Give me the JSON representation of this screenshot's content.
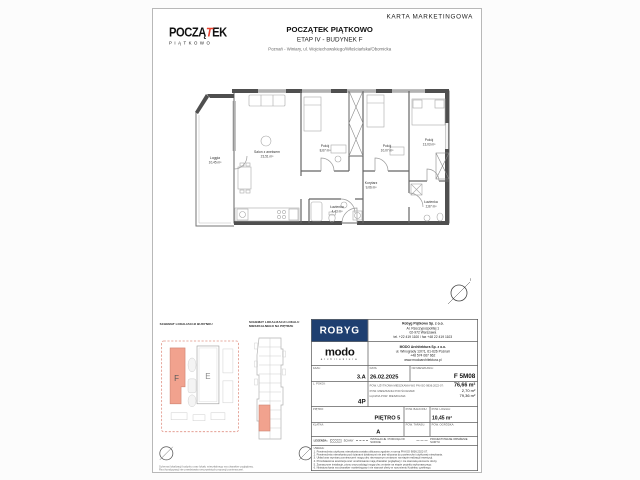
{
  "header": {
    "karta_label": "KARTA MARKETINGOWA",
    "logo": {
      "part1": "POCZĄ",
      "part2": "T",
      "part3": "EK",
      "sub": "PIĄTKOWO"
    },
    "title": "POCZĄTEK PIĄTKOWO",
    "subtitle": "ETAP IV - BUDYNEK F",
    "address": "Poznań - Winiary, ul. Wojciechowskiego/Włościańska/Obornicka"
  },
  "plan": {
    "rooms": [
      {
        "name": "Loggia",
        "area": "10,45 m²"
      },
      {
        "name": "Salon z aneksem",
        "area": "23,51 m²"
      },
      {
        "name": "Pokój",
        "area": "8,67 m²"
      },
      {
        "name": "Pokój",
        "area": "10,07 m²"
      },
      {
        "name": "Pokój",
        "area": "13,03 m²"
      },
      {
        "name": "Korytarz",
        "area": "9,06 m²"
      },
      {
        "name": "Łazienka",
        "area": "4,43 m²"
      },
      {
        "name": "Łazienka",
        "area": "2,87 m²"
      }
    ],
    "compass_letter": "N"
  },
  "schematics": {
    "building_title": "SCHEMAT LOKALIZACJI BUDYNKU",
    "floor_title_line1": "SCHEMAT LOKALIZACJI LOKALU",
    "floor_title_line2": "MIESZKALNEGO NA PIĘTRZE",
    "building_f": "F",
    "building_e": "E",
    "note_line1": "Schemat lokalizacji budynku oraz lokalu mieszkalnego ma charakter poglądowy.",
    "note_line2": "Rzut kondygnacji nie przedstawia rzeczywistych proporcji pomieszczeń."
  },
  "developer": {
    "logo": "ROBYG",
    "name": "Robyg Piątkowo Sp. z o.o.",
    "address1": "Al. Rzeczypospolitej 1",
    "address2": "02-972 Warszawa",
    "phone": "tel. +22 419 1100 / fax +48 22 419 1103"
  },
  "architect": {
    "logo": "modo",
    "logo_sub": "architektura",
    "name": "MODO Architektura Sp. z o.o.",
    "address1": "ul. Winogrady 137/1, 61-626 Poznań",
    "phone": "+48 574 067 662",
    "www": "www.modoarchitektura.pl"
  },
  "table": {
    "faza_label": "FAZA:",
    "faza": "3.A",
    "data_label": "DATA:",
    "data": "26.02.2025",
    "nr_label": "NR MIESZKANIA:",
    "nr": "F 5M08",
    "pokoi_label": "L. POKOI:",
    "pokoi": "4P",
    "area1_label": "POW. UŻYTKOWA MIESZKANIA WG PN-ISO 9836:2022-07:",
    "area1": "76,66 m²",
    "area2_label": "POW. MIESZKANIA POD ŚCIANAMI:",
    "area2": "2,70 m²",
    "area3_label": "ŁĄCZNA POW. MIESZKANIA:",
    "area3": "79,36 m²",
    "pietro_label": "PIĘTRO:",
    "pietro": "PIĘTRO 5",
    "balkon_label": "POW. BALKONU:",
    "balkon": "",
    "loggia_label": "POW. LOGGIA:",
    "loggia": "10,45 m²",
    "klatka_label": "KLATKA:",
    "klatka": "A",
    "taras_label": "POW. TARASU:",
    "taras": "",
    "ogrodek_label": "POW. OGRÓDKA:",
    "ogrodek": ""
  },
  "legend": {
    "label": "LEGENDA:",
    "item1": "ŚCIANY",
    "item2": "INSTALACJE / PODCIĄGI W SUFICIE",
    "item3": "PROJEKTOWANE OBNIŻENIE SUFITU"
  },
  "disclaimer_lines": [
    "UWAGA:",
    "1. Powierzchnia użytkowa mieszkania została obliczona zgodnie z normą PN-ISO 9836:2022-07.",
    "2. Powierzchnia mieszkania pod ścianami działowymi nie jest wliczana do powierzchni użytkowej mieszkania.",
    "3. Układ oraz wymiary pomieszczeń mogą ulec nieznacznym zmianom na etapie realizacji inwestycji.",
    "4. Przedstawiona aranżacja oraz umeblowanie mają charakter poglądowy i nie stanowią elementu oferty.",
    "5. Zaznaczone instalacje, piony oraz podciągi mogą ulec zmianie na etapie projektu wykonawczego.",
    "6. Niniejsza karta ma charakter marketingowy i nie stanowi oferty w rozumieniu Kodeksu cywilnego."
  ],
  "colors": {
    "robyg_navy": "#1e3f70",
    "highlight_salmon": "#f1a28e",
    "logo_red": "#e8412f",
    "dashed_red": "#e09184"
  }
}
